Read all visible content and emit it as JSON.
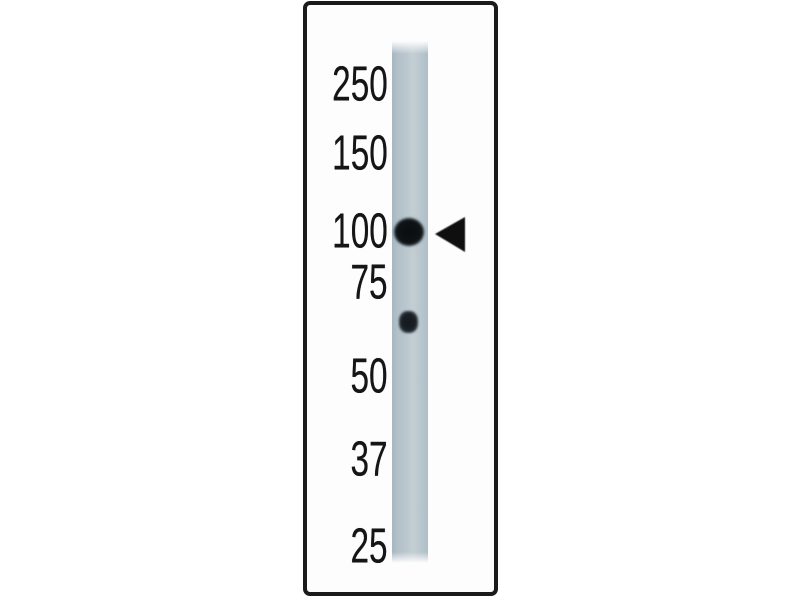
{
  "figure": {
    "kind": "western-blot-lane",
    "colors": {
      "page_background": "#ffffff",
      "panel_background": "#fdfdfd",
      "panel_border": "#1b1b1b",
      "lane": "#b9c6cd",
      "band": "#0e1215",
      "arrow": "#0f0f0f",
      "label_text": "#151515"
    },
    "markers": [
      "250",
      "150",
      "100",
      "75",
      "50",
      "37",
      "25"
    ],
    "bands": [
      {
        "description": "strong dark band aligned with 100 marker",
        "indicated_by_arrow": true
      },
      {
        "description": "small faint band between 75 and 50 markers",
        "indicated_by_arrow": false
      }
    ],
    "icons": {
      "band_indicator": "left-pointing-filled-triangle"
    }
  }
}
